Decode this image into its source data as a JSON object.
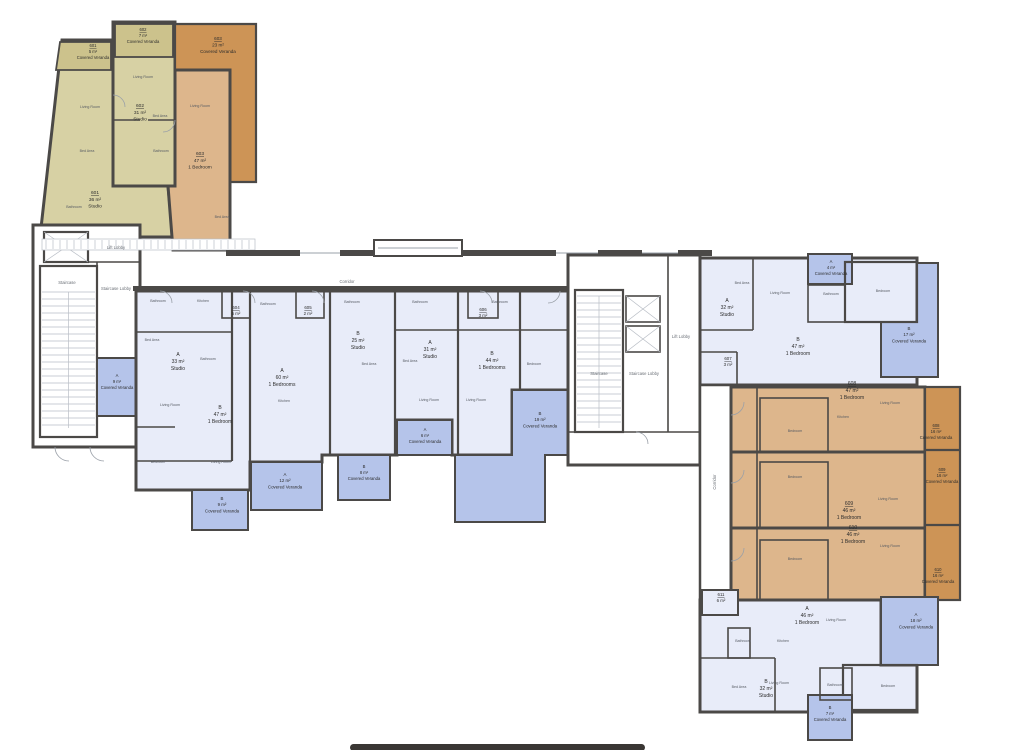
{
  "units": {
    "u601": {
      "number": "601",
      "area": "36 m²",
      "type": "Studio"
    },
    "u601v": {
      "number": "601",
      "area": "5 m²",
      "type": "Covered Veranda"
    },
    "u602": {
      "number": "602",
      "area": "31 m²",
      "type": "Studio"
    },
    "u602v": {
      "number": "602",
      "area": "7 m²",
      "type": "Covered Veranda"
    },
    "u603": {
      "number": "603",
      "area": "47 m²",
      "type": "1 Bedroom"
    },
    "u603v": {
      "number": "603",
      "area": "23 m²",
      "type": "Covered Veranda"
    },
    "u604": {
      "number": "604",
      "area": "5 m²"
    },
    "u605": {
      "number": "605",
      "area": "2 m²"
    },
    "u606": {
      "number": "606",
      "area": "3 m²"
    },
    "u607": {
      "number": "607",
      "area": "3 m²"
    },
    "u611": {
      "number": "611",
      "area": "6 m²"
    },
    "uA33": {
      "number": "A",
      "area": "33 m²",
      "type": "Studio"
    },
    "uB47": {
      "number": "B",
      "area": "47 m²",
      "type": "1 Bedroom"
    },
    "uA60": {
      "number": "A",
      "area": "60 m²",
      "type": "1 Bedrooms"
    },
    "uB25": {
      "number": "B",
      "area": "25 m²",
      "type": "Studio"
    },
    "uA31": {
      "number": "A",
      "area": "31 m²",
      "type": "Studio"
    },
    "uB44": {
      "number": "B",
      "area": "44 m²",
      "type": "1 Bedrooms"
    },
    "uA32": {
      "number": "A",
      "area": "32 m²",
      "type": "Studio"
    },
    "uB47r": {
      "number": "B",
      "area": "47 m²",
      "type": "1 Bedroom"
    },
    "u608": {
      "number": "608",
      "area": "47 m²",
      "type": "1 Bedroom"
    },
    "u608v": {
      "number": "608",
      "area": "16 m²",
      "type": "Covered Veranda"
    },
    "u609": {
      "number": "609",
      "area": "46 m²",
      "type": "1 Bedroom"
    },
    "u609v": {
      "number": "609",
      "area": "16 m²",
      "type": "Covered Veranda"
    },
    "u610": {
      "number": "610",
      "area": "46 m²",
      "type": "1 Bedroom"
    },
    "u610v": {
      "number": "610",
      "area": "16 m²",
      "type": "Covered Veranda"
    },
    "uA46": {
      "number": "A",
      "area": "46 m²",
      "type": "1 Bedroom"
    },
    "uA18v": {
      "number": "A",
      "area": "18 m²",
      "type": "Covered Veranda"
    },
    "uB32": {
      "number": "B",
      "area": "32 m²",
      "type": "Studio"
    },
    "uB7v": {
      "number": "B",
      "area": "7 m²",
      "type": "Covered Veranda"
    },
    "uA9v": {
      "number": "A",
      "area": "9 m²",
      "type": "Covered Veranda"
    },
    "uA4v": {
      "number": "A",
      "area": "4 m²",
      "type": "Covered Veranda"
    },
    "uB17v": {
      "number": "B",
      "area": "17 m²",
      "type": "Covered Veranda"
    },
    "uB9v": {
      "number": "B",
      "area": "9 m²",
      "type": "Covered Veranda"
    },
    "uA12v": {
      "number": "A",
      "area": "12 m²",
      "type": "Covered Veranda"
    },
    "uB8v": {
      "number": "B",
      "area": "8 m²",
      "type": "Covered Veranda"
    },
    "uA6v": {
      "number": "A",
      "area": "6 m²",
      "type": "Covered Veranda"
    },
    "uB19v": {
      "number": "B",
      "area": "19 m²",
      "type": "Covered Veranda"
    }
  },
  "common": {
    "corridor": "Corridor",
    "staircase": "Staircase",
    "staircase_lobby": "Staircase Lobby",
    "lift_lobby": "Lift Lobby"
  },
  "room_labels": {
    "living_room": "Living Room",
    "bedroom": "Bedroom",
    "bed_area": "Bed Area",
    "bathroom": "Bathroom",
    "kitchen": "Kitchen"
  },
  "colors": {
    "wall": "#4b4947",
    "unit_blue": "#e8ecf9",
    "veranda_blue": "#b5c4ea",
    "unit_orange": "#ddb68c",
    "veranda_orange": "#cd9456",
    "unit_olive": "#d7d1a4",
    "veranda_olive": "#ccc28c"
  }
}
